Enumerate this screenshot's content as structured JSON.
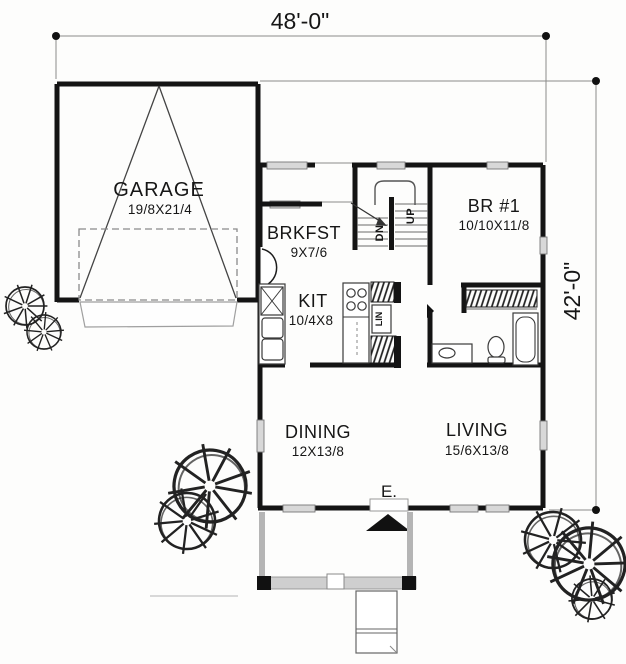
{
  "dimensions": {
    "width": "48'-0\"",
    "height": "42'-0\""
  },
  "rooms": {
    "garage": {
      "name": "GARAGE",
      "size": "19/8X21/4"
    },
    "breakfast": {
      "name": "BRKFST",
      "size": "9X7/6"
    },
    "kitchen": {
      "name": "KIT",
      "size": "10/4X8"
    },
    "bedroom1": {
      "name": "BR #1",
      "size": "10/10X11/8"
    },
    "dining": {
      "name": "DINING",
      "size": "12X13/8"
    },
    "living": {
      "name": "LIVING",
      "size": "15/6X13/8"
    }
  },
  "annotations": {
    "stairs_up": "UP",
    "stairs_down": "DN",
    "linen": "LIN",
    "entry": "E."
  },
  "colors": {
    "wall": "#141414",
    "window_fill": "#d8d8d8",
    "porch_gray": "#c9c9c9",
    "background": "#fdfdfc"
  }
}
